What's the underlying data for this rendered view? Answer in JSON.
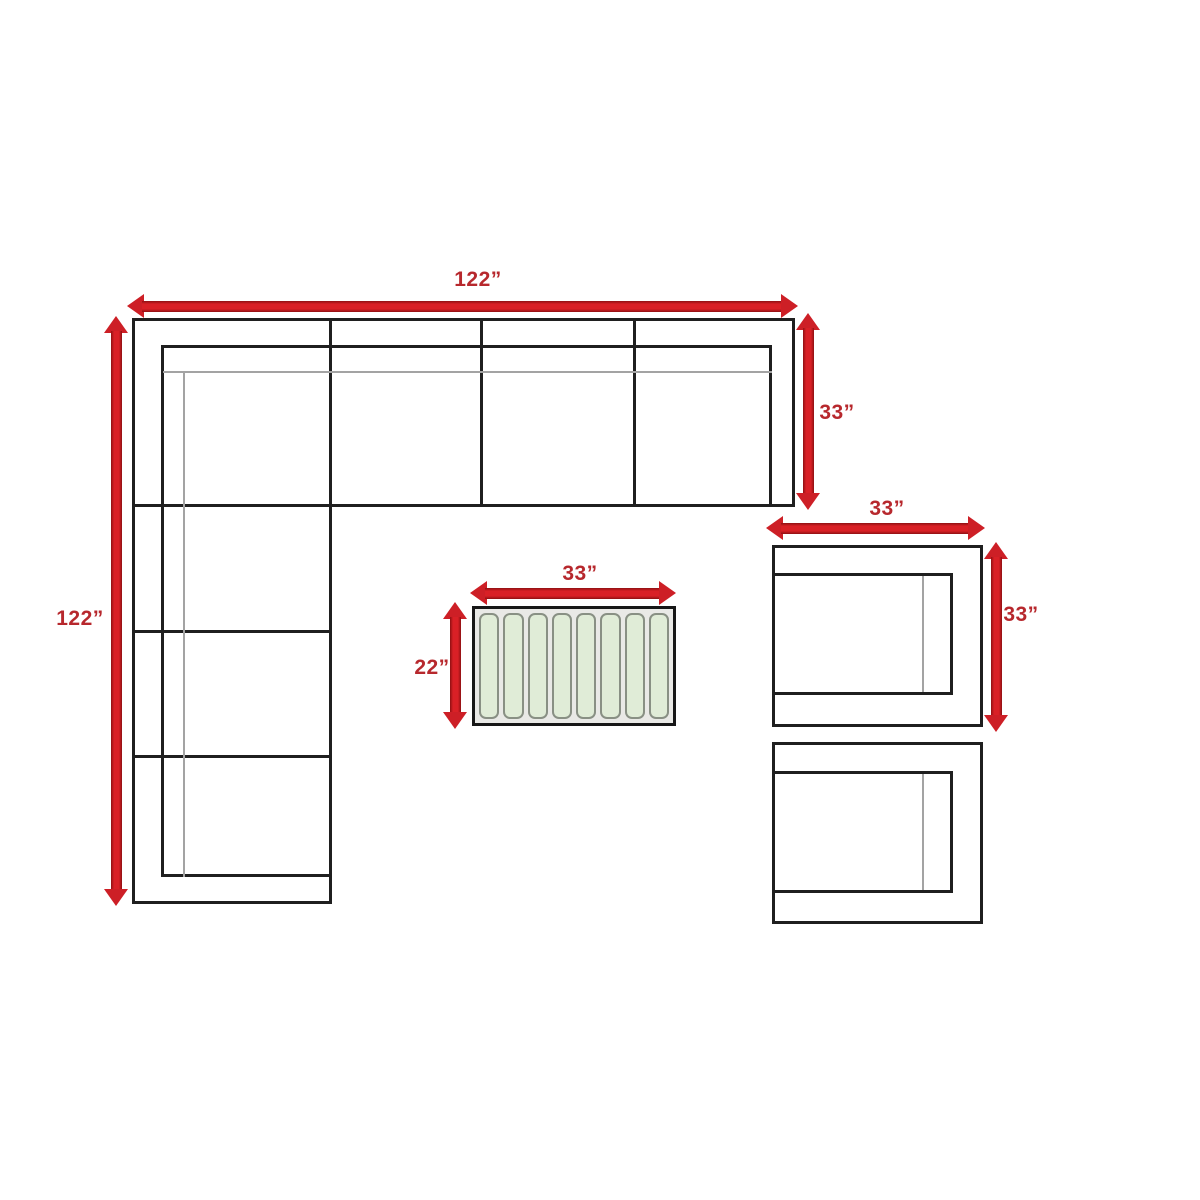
{
  "diagram": {
    "type": "furniture-dimension-plan",
    "colors": {
      "arrow": "#cd1f26",
      "arrow_edge": "#8f1013",
      "label_text": "#b7282d",
      "outline": "#1f1f1f",
      "thin_line": "#a3a3a3",
      "table_background": "#e9e9e6",
      "slat_fill": "#e0ecd7",
      "slat_border": "#899084"
    },
    "sectional": {
      "width_label": "122”",
      "height_label": "122”",
      "depth_label": "33”",
      "top_seats": 4,
      "side_seats": 3
    },
    "coffee_table": {
      "width_label": "33”",
      "depth_label": "22”",
      "slat_count": 8
    },
    "chair": {
      "width_label": "33”",
      "depth_label": "33”"
    }
  }
}
